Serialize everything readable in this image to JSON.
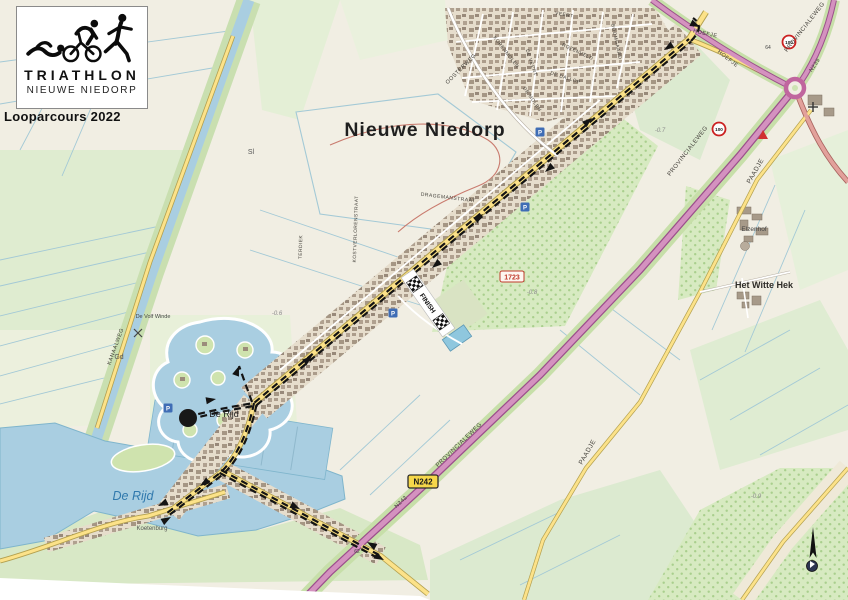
{
  "logo": {
    "title": "TRIATHLON",
    "subtitle": "NIEUWE NIEDORP",
    "caption": "Looparcours 2022"
  },
  "map": {
    "town": "Nieuwe Niedorp",
    "water": {
      "de_rijd": "De Rijd",
      "de_rijd_harbor": "De Rijd"
    },
    "places": {
      "koetenburg": "Koetenburg",
      "elzenhof": "Elzenhof",
      "het_witte_hek": "Het Witte Hek",
      "de_volf_winde": "De Volf Winde",
      "gd": "Gd",
      "sl": "Sl"
    },
    "streets": {
      "kanaalweg": "KANAALWEG",
      "oosterweg": "OOSTERWEG",
      "korenmolen": "KORENMOLEN",
      "de_veert": "DE VEERT",
      "veert": "VEERT",
      "rozenveld": "ROZENVELD",
      "de_dallop": "DE DALLOP",
      "de_molen": "DE MOLEN",
      "boomgaard": "BOOMGAARD",
      "hoefje": "HOEFJE",
      "provincialeweg": "PROVINCIALEWEG",
      "n242": "N242",
      "n239": "N239",
      "paadje": "PAADJE",
      "dragemanstraat": "DRAGEMANSTRAAT",
      "kostverlorenstraat": "KOSTVERLORENSTRAAT",
      "terdiek": "TERDIEK"
    },
    "route": {
      "finish": "FINISH"
    },
    "signs": {
      "n242_shield": "N242",
      "speed_100": "100",
      "parking": "P",
      "parcel": "1723"
    },
    "annotations": {
      "d07": "-0.7",
      "d08": "-0.8",
      "d06": "-0.6",
      "d09": "-0.9",
      "n62": "62",
      "n64": "64"
    }
  },
  "colors": {
    "water": "#a9cee1",
    "field_green": "#dfecd0",
    "orchard_green": "#d7eac1",
    "road_yellow": "#fce289",
    "road_pink": "#d492bf",
    "road_pink_casing": "#9c4f8c",
    "route_black": "#141414",
    "accent_red": "#cc2a2a",
    "urban_brown": "#a59684"
  }
}
